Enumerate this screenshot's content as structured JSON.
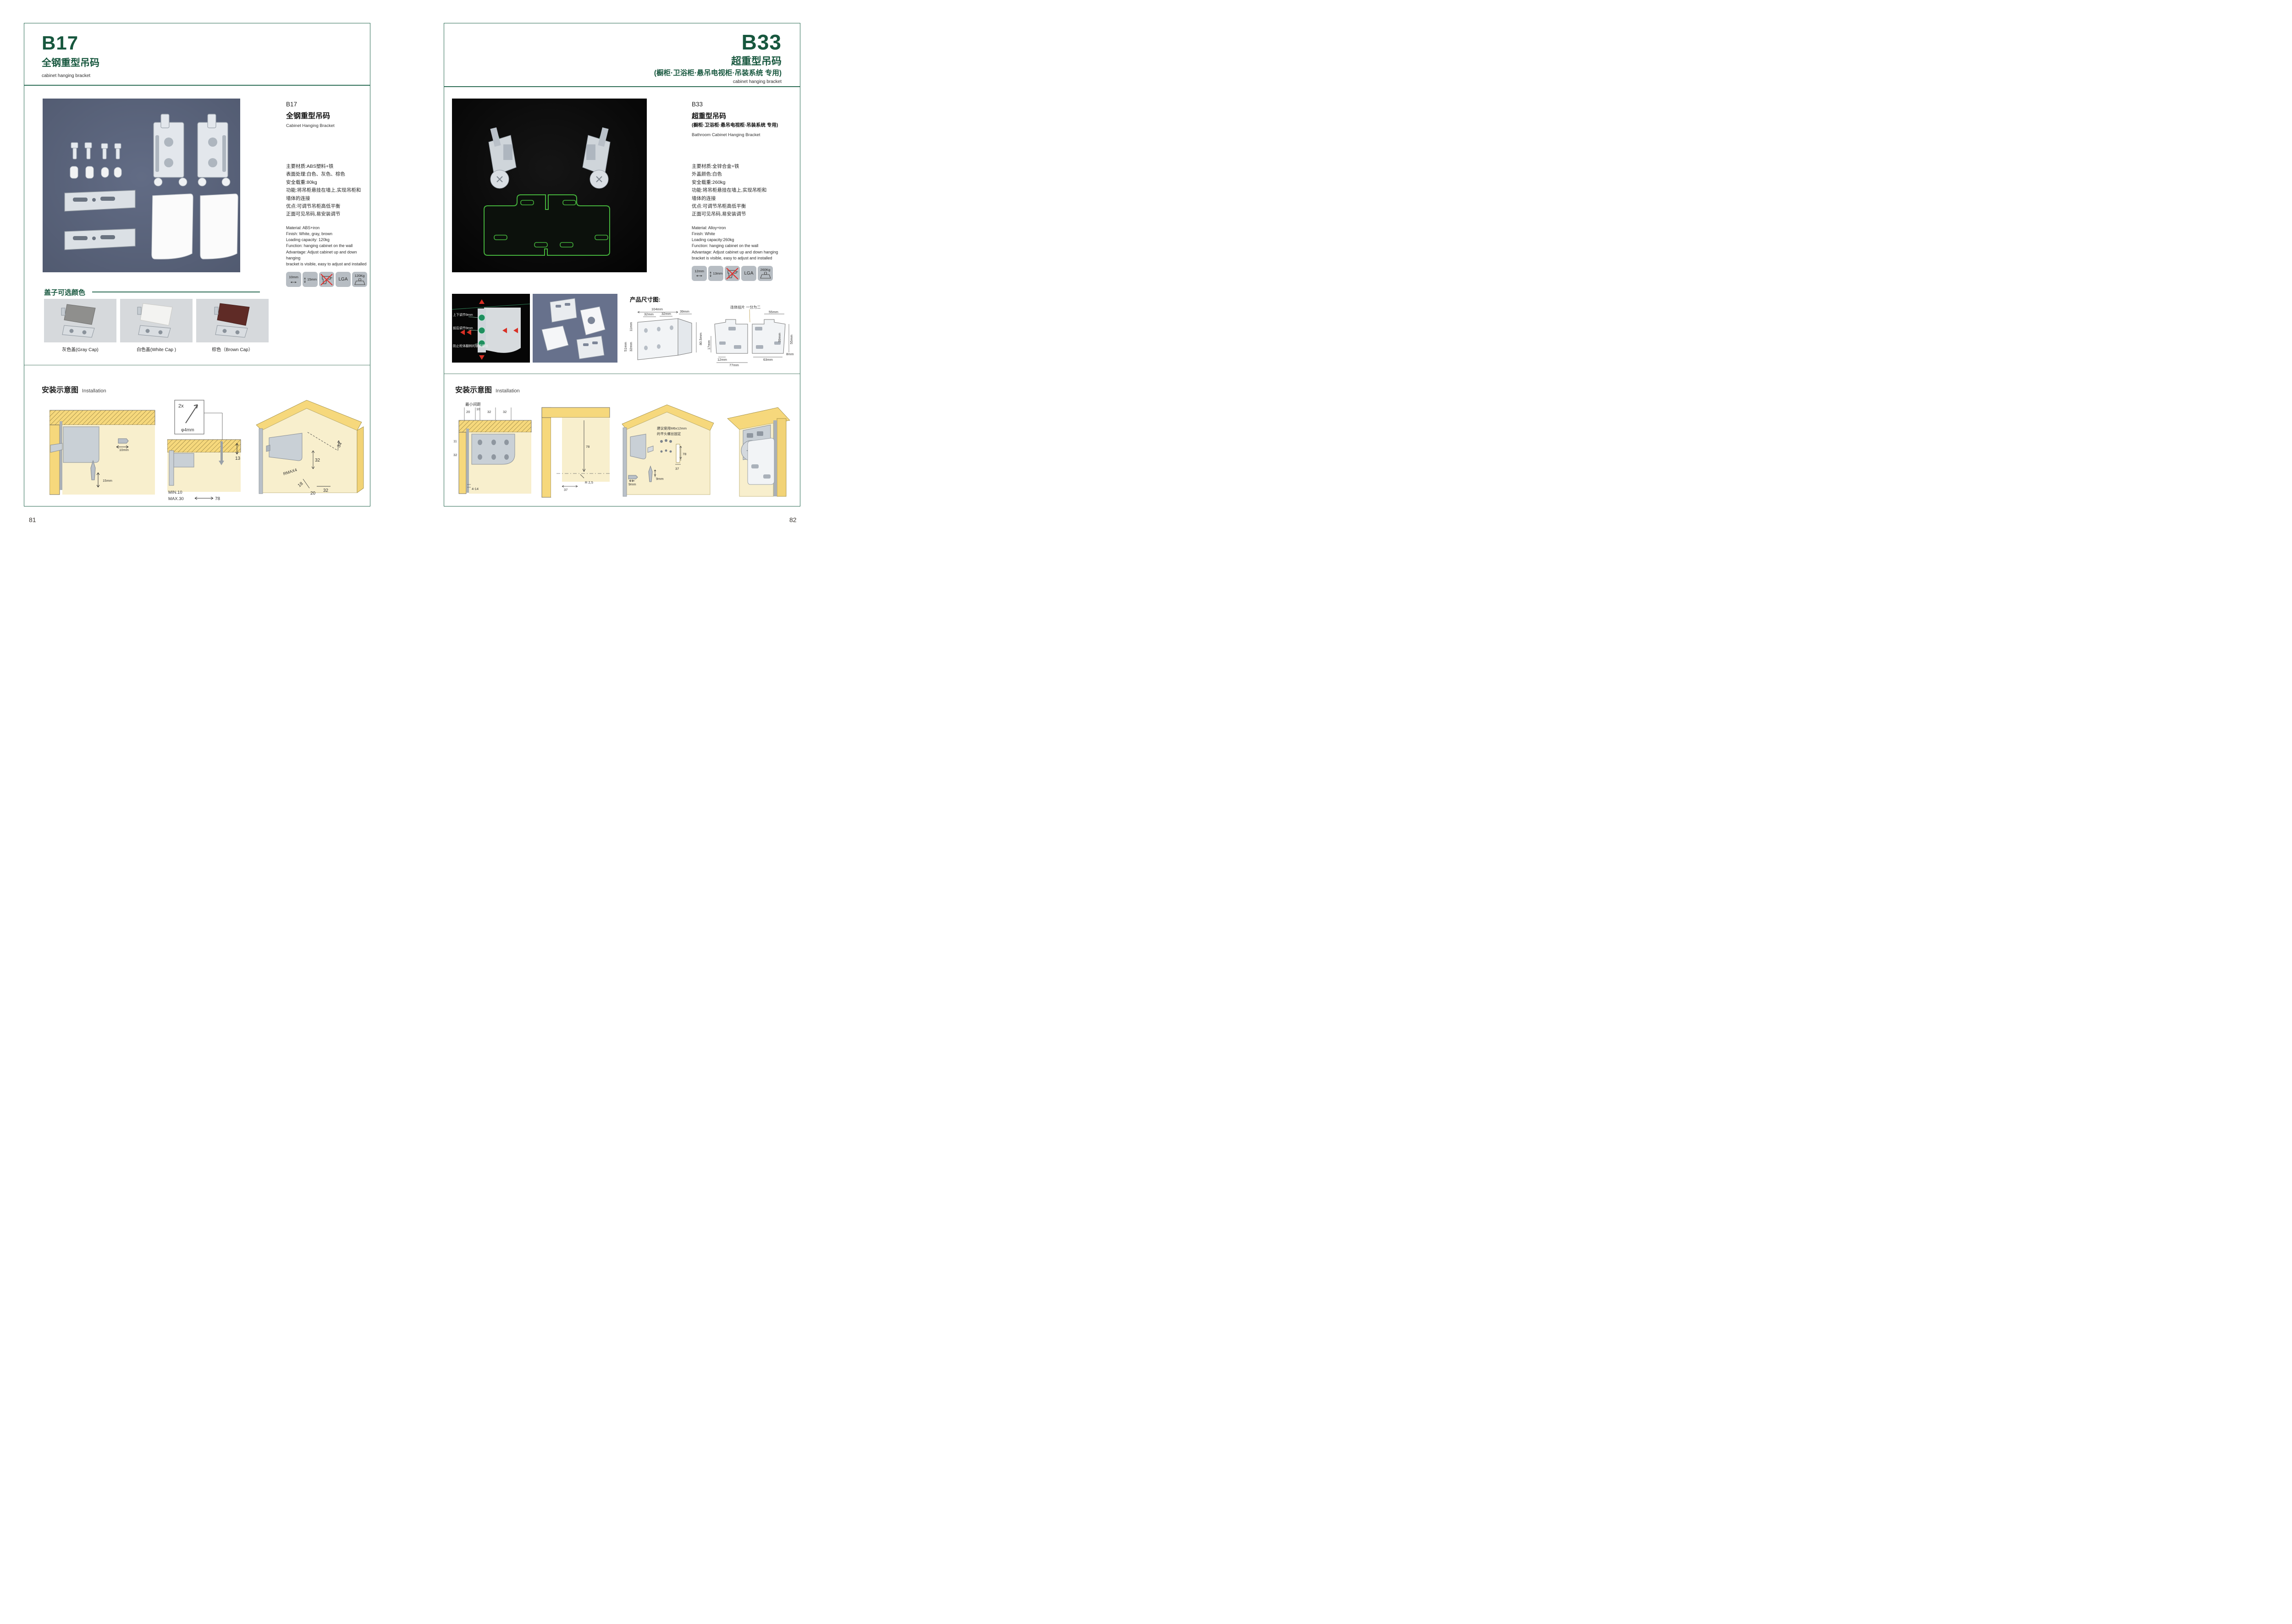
{
  "left": {
    "header": {
      "code": "B17",
      "title": "全钢重型吊码",
      "subtitle": "cabinet hanging bracket"
    },
    "detail": {
      "code": "B17",
      "name_cn": "全钢重型吊码",
      "name_en": "Cabinet Hanging Bracket",
      "specs_cn": [
        "主要材质:ABS塑料+铁",
        "表面处理:白色、灰色、棕色",
        "安全载重:80kg",
        "功能:将吊柜悬挂在墙上,实现吊柜和",
        "墙体的连接",
        "优点:可调节吊柜高低平衡",
        "正面可见吊码,易安装调节"
      ],
      "specs_en": [
        "Material: ABS+iron",
        "Finish: White, gray, brown",
        "Loading capacity: 120kg",
        "Function: hanging cabinet on the wall",
        "Advantage: Adjust cabinet up and down hanging",
        "bracket is visible, easy to adjust and installed"
      ],
      "icons": {
        "width": "10mm",
        "height": "15mm",
        "cert": "LGA",
        "load": "120Kg"
      }
    },
    "caps": {
      "title": "盖子可选颜色",
      "captions": [
        "灰色盖(Gray Cap)",
        "白色盖(White Cap )",
        "棕色（Brown Cap）"
      ],
      "colors": [
        "#8f8f8d",
        "#f3f3f1",
        "#5f2b26"
      ]
    },
    "install": {
      "title_cn": "安装示意图",
      "title_en": "Installation",
      "a": {
        "w": "10mm",
        "h": "15mm"
      },
      "screwbox": {
        "qty": "2x",
        "dia": "φ4mm"
      },
      "b": {
        "right": "13",
        "min": "MIN.10",
        "max": "MAX.30",
        "bottom": "78"
      },
      "c": {
        "a": "34",
        "b": "32",
        "r": "RMAX4",
        "c": "18",
        "d": "20",
        "e": "32"
      }
    },
    "page_number": "81"
  },
  "right": {
    "header": {
      "code": "B33",
      "title": "超重型吊码",
      "subtitle": "(橱柜·卫浴柜·悬吊电视柜·吊装系统 专用)",
      "subtitle_en": "cabinet hanging bracket"
    },
    "detail": {
      "code": "B33",
      "name_cn": "超重型吊码",
      "name_cn2": "(橱柜·卫浴柜·悬吊电视柜·吊装系统 专用)",
      "name_en": "Bathroom Cabinet Hanging Bracket",
      "specs_cn": [
        "主要材质:全锌合金+铁",
        "外盖颜色:白色",
        "安全载重:260kg",
        "功能:将吊柜悬挂在墙上,实现吊柜和",
        "墙体的连接",
        "优点:可调节吊柜高低平衡",
        "正面可见吊码,易安装调节"
      ],
      "specs_en": [
        "Material: Alloy+iron",
        "Finish: White",
        "Loading capacity:260kg",
        "Function: hanging cabinet on the wall",
        "Advantage: Adjust cabinet up and down hanging",
        "bracket is visible, easy to adjust and installed"
      ],
      "icons": {
        "width": "12mm",
        "height": "13mm",
        "cert": "LGA",
        "load": "260Kg"
      }
    },
    "photo_annot": {
      "a": "上下调节9mm",
      "b": "前后调节9mm",
      "c": "防止柜体翻转的锁紧螺丝"
    },
    "dims": {
      "title": "产品尺寸图:",
      "d1": [
        "104mm",
        "32mm",
        "32mm",
        "39mm",
        "11mm",
        "32mm",
        "51mm",
        "80.5mm"
      ],
      "d2_label": "连体挂片 一分为二",
      "d2": [
        "55mm",
        "39mm",
        "55mm",
        "8mm",
        "17mm",
        "12mm",
        "63mm",
        "77mm"
      ]
    },
    "install": {
      "title_cn": "安装示意图",
      "title_en": "Installation",
      "q1": {
        "min_label": "最小间距",
        "t1": "20",
        "t2": "10",
        "t3": "32",
        "t4": "32",
        "l1": "11",
        "l2": "32",
        "b1": "4-14"
      },
      "q2": {
        "a": "78",
        "b": "R 2,5",
        "c": "37"
      },
      "q3": {
        "note1": "建议使用M6x12mm",
        "note2": "的平头螺丝固定",
        "a": "78",
        "b": "37",
        "c": "9mm",
        "d": "9mm"
      }
    },
    "page_number": "82"
  }
}
